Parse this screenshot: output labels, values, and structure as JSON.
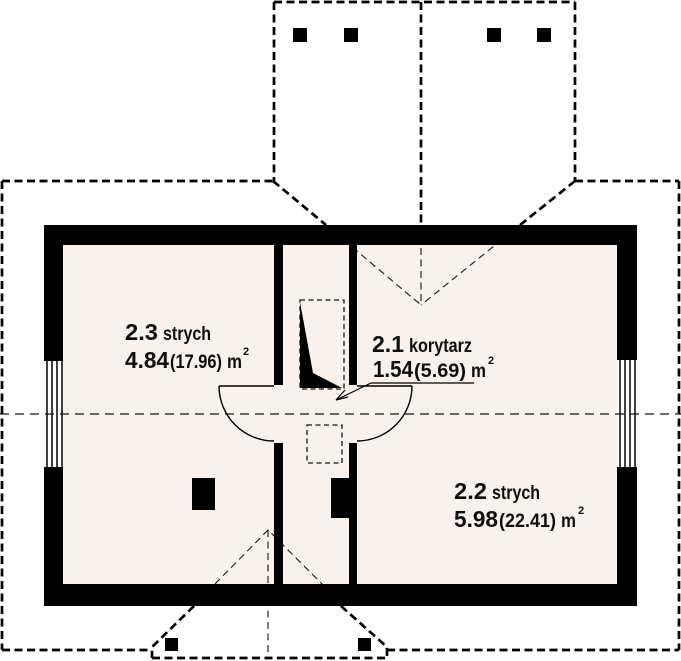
{
  "plan": {
    "rooms": [
      {
        "number": "2.3",
        "name": "strych",
        "area_value": "4.84",
        "area_total": "(17.96)",
        "unit": "m",
        "unit_sup": "2"
      },
      {
        "number": "2.1",
        "name": "korytarz",
        "area_value": "1.54",
        "area_total": "(5.69)",
        "unit": "m",
        "unit_sup": "2"
      },
      {
        "number": "2.2",
        "name": "strych",
        "area_value": "5.98",
        "area_total": "(22.41)",
        "unit": "m",
        "unit_sup": "2"
      }
    ],
    "colors": {
      "wall": "#000000",
      "floor_fill": "#f8f1ec",
      "paper": "#ffffff",
      "line": "#161616"
    }
  }
}
